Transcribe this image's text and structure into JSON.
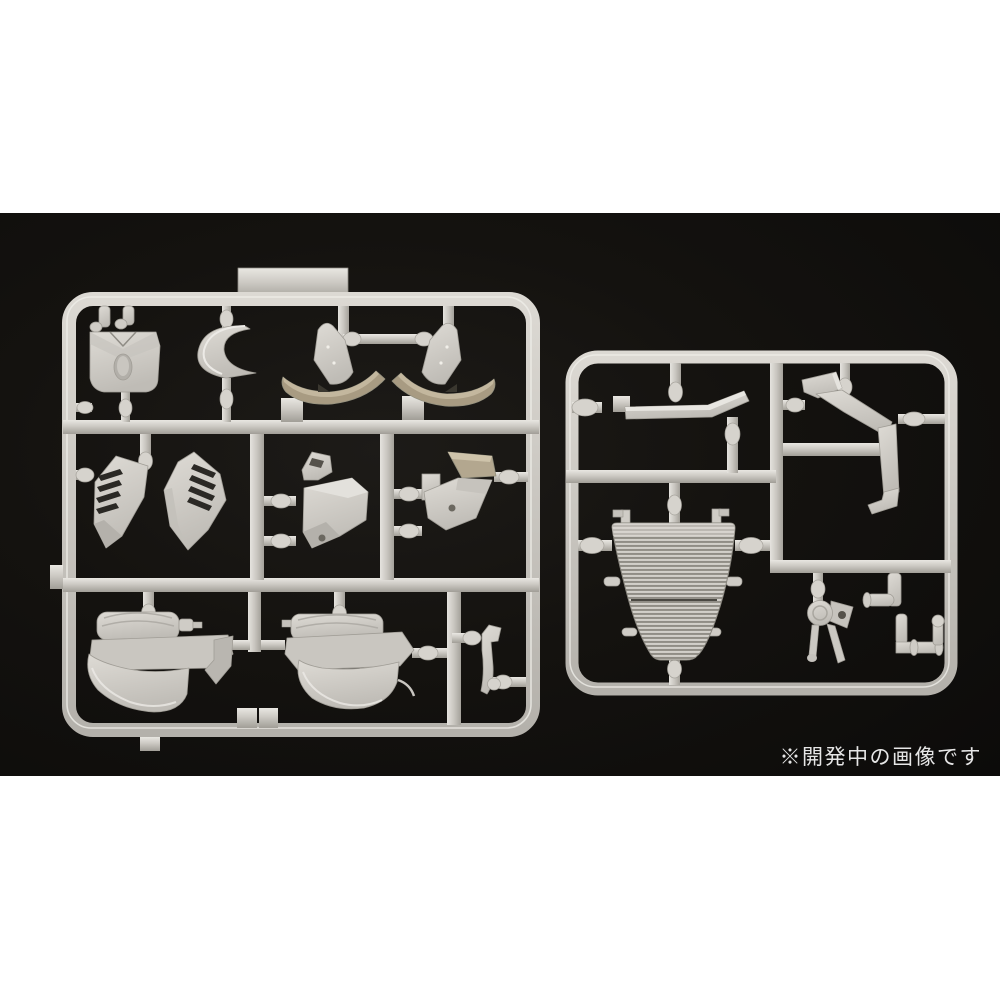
{
  "page": {
    "background": "#ffffff"
  },
  "photo": {
    "caption": "※開発中の画像です",
    "caption_color": "#e6e6e6",
    "background_color": "#131210"
  },
  "palette": {
    "plastic_base": "#d2cfc9",
    "plastic_highlight": "#eae8e3",
    "plastic_shadow": "#9d9a93",
    "plastic_tan": "#a89b82"
  },
  "sprues": {
    "left": {
      "name": "large-runner",
      "parts": [
        "front-cowl",
        "windscreen",
        "tail-cowl-left",
        "tail-cowl-right",
        "vent-panel-left",
        "vent-panel-right",
        "side-duct-left",
        "side-duct-right",
        "tank-cover-left",
        "tank-cover-right",
        "small-lever"
      ]
    },
    "right": {
      "name": "small-runner",
      "parts": [
        "stay-arm",
        "frame-pipe",
        "radiator",
        "pump-unit",
        "elbow-pipe",
        "hose-joint"
      ]
    }
  }
}
